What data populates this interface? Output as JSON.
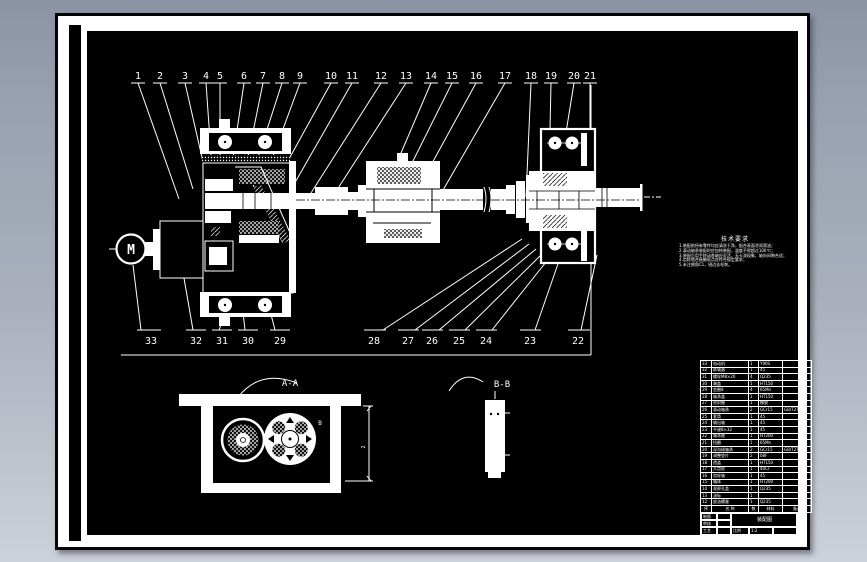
{
  "colors": {
    "background_top": "#8a94a5",
    "background_bottom": "#cdd1d9",
    "paper": "#ffffff",
    "canvas": "#000000",
    "ink": "#ffffff"
  },
  "labels": {
    "motor": "M",
    "section_a": "A-A",
    "section_b": "B-B",
    "b_mark_1": "B",
    "b_mark_2": "B",
    "dim_mark": "2"
  },
  "callouts": {
    "top": [
      "1",
      "2",
      "3",
      "4",
      "5",
      "6",
      "7",
      "8",
      "9",
      "10",
      "11",
      "12",
      "13",
      "14",
      "15",
      "16",
      "17",
      "18",
      "19",
      "20",
      "21"
    ],
    "bottom": [
      "33",
      "32",
      "31",
      "30",
      "29",
      "28",
      "27",
      "26",
      "25",
      "24",
      "23",
      "22"
    ]
  },
  "tech_requirements": {
    "title": "技术要求",
    "lines": [
      "1.装配前所有零件均应清洗干净，配合表面涂润滑油；",
      "2.滚动轴承装配时应加热装配，温度不得超过100℃；",
      "3.装配后用手转动各轴应灵活，无卡滞现象，轴向间隙合适；",
      "4.齿轮啮合接触斑点应符合规定要求；",
      "5.未注倒角C1，锐边去毛刺。"
    ]
  },
  "parts_table": {
    "headers": [
      "序",
      "名  称",
      "数",
      "材料",
      "备注"
    ],
    "rows": [
      [
        "33",
        "电动机",
        "1",
        "Y90S",
        ""
      ],
      [
        "32",
        "联轴器",
        "1",
        "45",
        ""
      ],
      [
        "31",
        "螺栓M8×20",
        "4",
        "Q235",
        ""
      ],
      [
        "30",
        "端盖",
        "1",
        "HT150",
        ""
      ],
      [
        "29",
        "垫圈8",
        "4",
        "65Mn",
        ""
      ],
      [
        "28",
        "轴承盖",
        "1",
        "HT150",
        ""
      ],
      [
        "27",
        "密封圈",
        "1",
        "橡胶",
        ""
      ],
      [
        "26",
        "滚动轴承",
        "2",
        "GCr15",
        "GB/T276"
      ],
      [
        "25",
        "套筒",
        "1",
        "45",
        ""
      ],
      [
        "24",
        "输出轴",
        "1",
        "45",
        ""
      ],
      [
        "23",
        "平键8×32",
        "1",
        "45",
        ""
      ],
      [
        "22",
        "轴承座",
        "1",
        "HT200",
        ""
      ],
      [
        "21",
        "挡圈",
        "1",
        "65Mn",
        ""
      ],
      [
        "20",
        "深沟球轴承",
        "2",
        "GCr15",
        "GB/T276"
      ],
      [
        "19",
        "调整垫片",
        "2",
        "08F",
        ""
      ],
      [
        "18",
        "透盖",
        "1",
        "HT150",
        ""
      ],
      [
        "17",
        "大齿轮",
        "1",
        "40Cr",
        ""
      ],
      [
        "16",
        "齿轮轴",
        "1",
        "45",
        ""
      ],
      [
        "15",
        "箱体",
        "1",
        "HT200",
        ""
      ],
      [
        "14",
        "观察孔盖",
        "1",
        "Q235",
        ""
      ],
      [
        "13",
        "油标",
        "1",
        "",
        ""
      ],
      [
        "12",
        "放油螺塞",
        "1",
        "Q235",
        ""
      ]
    ]
  },
  "title_block": {
    "design_label": "制图",
    "check_label": "审核",
    "process_label": "工艺",
    "drawing_name": "装配图",
    "scale_label": "比例",
    "scale_value": "1:2"
  }
}
